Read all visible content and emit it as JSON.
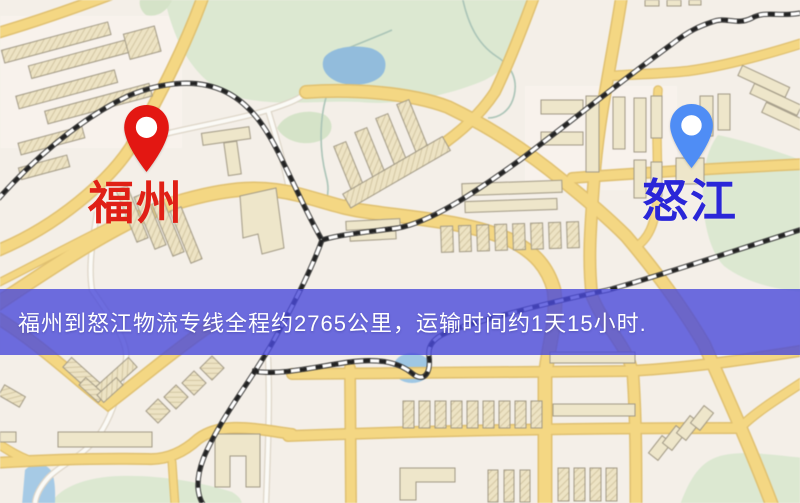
{
  "map_image": {
    "description_labels": {
      "origin": {
        "name": "福州",
        "pin_color": "#e31712",
        "pin_hole_color": "#ffffff",
        "label_color": "#e02016"
      },
      "destination": {
        "name": "怒江",
        "pin_color": "#4f8df5",
        "pin_hole_color": "#ffffff",
        "label_color": "#2a26d8"
      }
    },
    "colors": {
      "land": "#f4efe7",
      "road_fill": "#f6d77d",
      "road_casing": "#e2c06a",
      "park_green": "#dbe8d0",
      "water_blue": "#8fbcdf",
      "building_tan": "#efe6c8",
      "railway_dark": "#2b2b2b"
    }
  },
  "banner": {
    "text": "福州到怒江物流专线全程约2765公里，运输时间约1天15小时.",
    "origin": "福州",
    "destination": "怒江",
    "distance_text": "2765公里",
    "duration_text": "1天15小时",
    "background_color": "#4a4ada",
    "text_color": "#ffffff"
  }
}
